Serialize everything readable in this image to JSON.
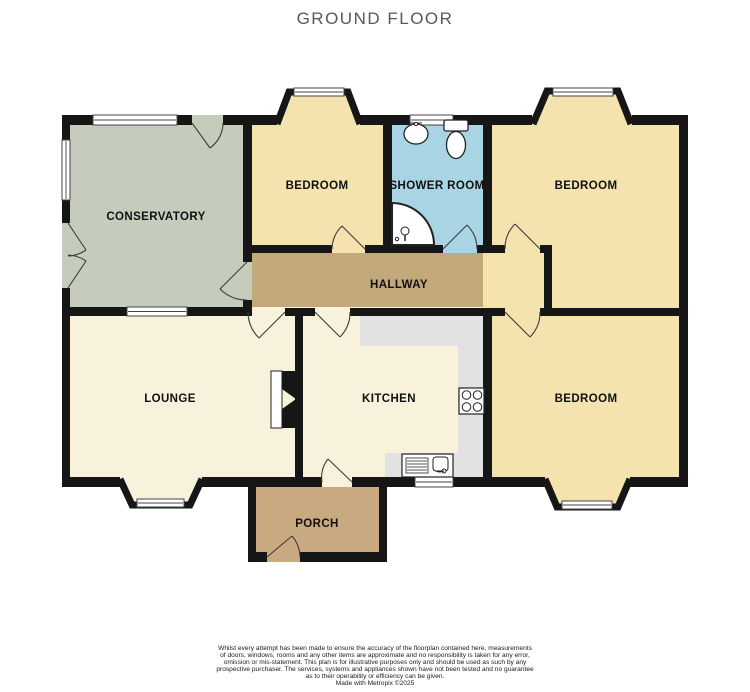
{
  "title": "GROUND FLOOR",
  "palette": {
    "wall": "#161616",
    "bedroom": "#f4e3ae",
    "conservatory": "#c5ccbc",
    "shower": "#a9d4e4",
    "hallway": "#c2a87a",
    "porch": "#c9aa80",
    "lounge": "#f8f2dc",
    "kitchen": "#f8f2dc",
    "counter": "#e2e2e2",
    "window_frame": "#444444",
    "door": "#3c3c3c",
    "fixture_stroke": "#222222",
    "label": "#101010",
    "title_color": "#57585a",
    "footer_color": "#1a1a1a"
  },
  "rooms": [
    {
      "id": "conservatory",
      "label": "CONSERVATORY"
    },
    {
      "id": "bedroom-top-middle",
      "label": "BEDROOM"
    },
    {
      "id": "shower-room",
      "label": "SHOWER ROOM"
    },
    {
      "id": "bedroom-top-right",
      "label": "BEDROOM"
    },
    {
      "id": "hallway",
      "label": "HALLWAY"
    },
    {
      "id": "lounge",
      "label": "LOUNGE"
    },
    {
      "id": "kitchen",
      "label": "KITCHEN"
    },
    {
      "id": "bedroom-bottom-right",
      "label": "BEDROOM"
    },
    {
      "id": "porch",
      "label": "PORCH"
    }
  ],
  "fixtures": [
    "basin",
    "toilet",
    "corner-shower",
    "hob",
    "kitchen-sink",
    "fireplace"
  ],
  "footer": {
    "lines": [
      "Whilst every attempt has been made to ensure the accuracy of the floorplan contained here, measurements",
      "of doors, windows, rooms and any other items are approximate and no responsibility is taken for any error,",
      "omission or mis-statement. This plan is for illustrative purposes only and should be used as such by any",
      "prospective purchaser. The services, systems and appliances shown have not been tested and no guarantee",
      "as to their operability or efficiency can be given.",
      "Made with Metropix ©2025"
    ]
  }
}
